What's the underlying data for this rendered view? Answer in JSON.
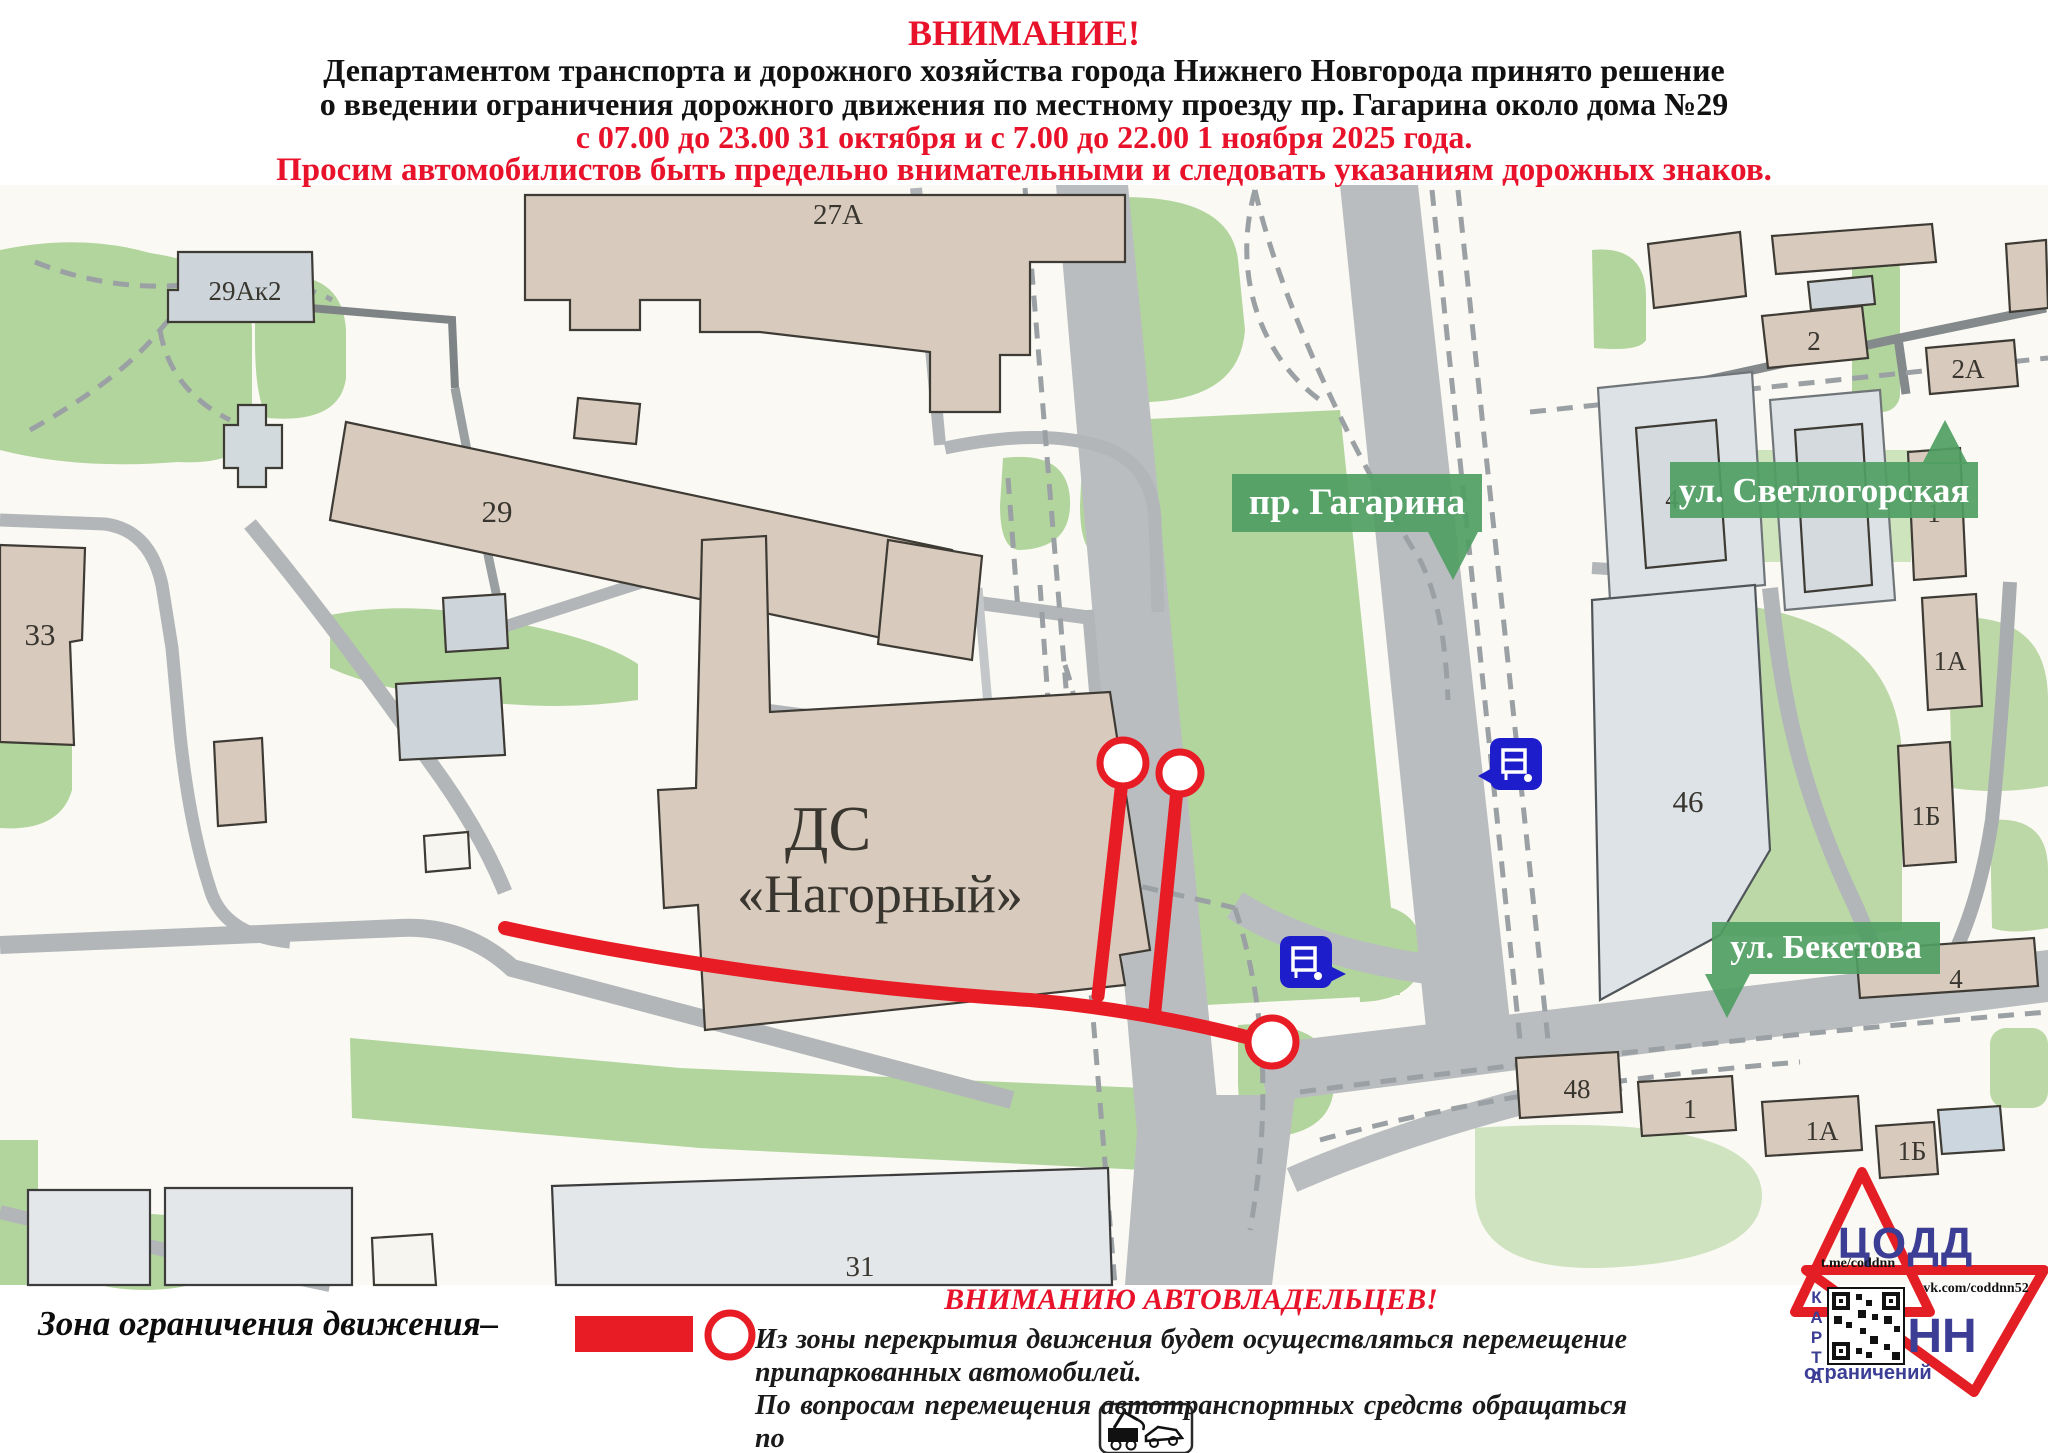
{
  "header": {
    "line1": "ВНИМАНИЕ!",
    "line2": "Департаментом транспорта и дорожного хозяйства города Нижнего Новгорода принято решение",
    "line3": "о введении ограничения дорожного движения по местному проезду пр. Гагарина около дома №29",
    "line4": "с 07.00 до 23.00 31 октября и с 7.00 до 22.00 1 ноября 2025 года.",
    "line5": "Просим автомобилистов быть предельно внимательными и следовать указаниям дорожных знаков."
  },
  "map": {
    "streets": [
      "пр. Гагарина",
      "ул. Светлогорская",
      "ул. Бекетова"
    ],
    "venue": {
      "line1": "ДС",
      "line2": "«Нагорный»"
    },
    "building_labels": [
      "29Ак2",
      "27А",
      "29",
      "33",
      "2",
      "2А",
      "4",
      "1",
      "1А",
      "1Б",
      "46",
      "4",
      "48",
      "1",
      "1А",
      "1Б",
      "31"
    ],
    "icons": [
      "bus-stop",
      "bus-stop"
    ]
  },
  "legend": {
    "zone_label": "Зона ограничения движения–"
  },
  "notice": {
    "title": "ВНИМАНИЮ АВТОВЛАДЕЛЬЦЕВ!",
    "line1": "Из зоны перекрытия движения будет осуществляться перемещение",
    "line2": "припаркованных автомобилей.",
    "line3": "По вопросам перемещения автотранспортных средств обращаться по",
    "line4_prefix": "телефону ",
    "phone": "417-17-07"
  },
  "logo": {
    "org": "ЦОДД",
    "city": "НН",
    "vertical_word": "КАРТА",
    "bottom_word": "ограничений",
    "telegram": "t.me/coddnn",
    "vk": "vk.com/coddnn52"
  },
  "colors": {
    "accent_red": "#e8132b",
    "map_green": "#b2d59d",
    "street_label_green": "#4f9e63",
    "road_gray": "#b9bdc0",
    "building_beige": "#d8cabd",
    "bus_blue": "#1d1dcb"
  }
}
